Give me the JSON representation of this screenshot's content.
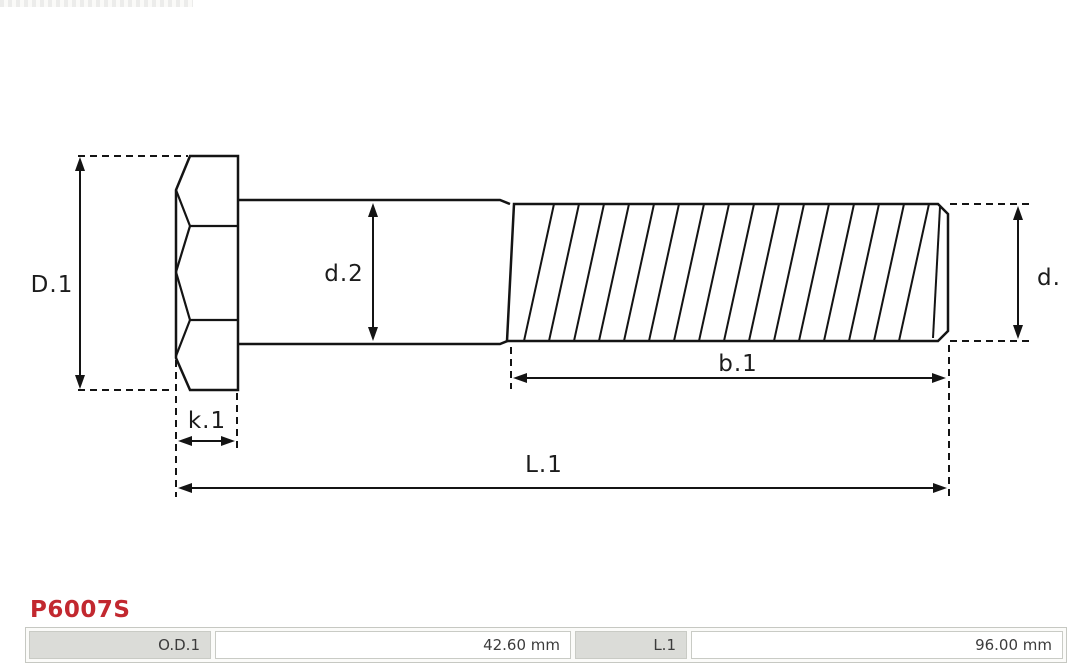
{
  "accent_color": "#c2282f",
  "line_color": "#141414",
  "watermark": {
    "name": "truncated-watermark-strip"
  },
  "diagram": {
    "type": "technical-drawing",
    "subject": "hex-head bolt side view with thread",
    "labels": {
      "head_diameter": "D.1",
      "shank_diameter": "d.2",
      "thread_diameter": "d.",
      "thread_length": "b.1",
      "head_thickness": "k.1",
      "total_length": "L.1"
    }
  },
  "part_number": "P6007S",
  "spec_table": {
    "entries": [
      {
        "name": "O.D.1",
        "value": "42.60 mm"
      },
      {
        "name": "L.1",
        "value": "96.00 mm"
      }
    ]
  }
}
